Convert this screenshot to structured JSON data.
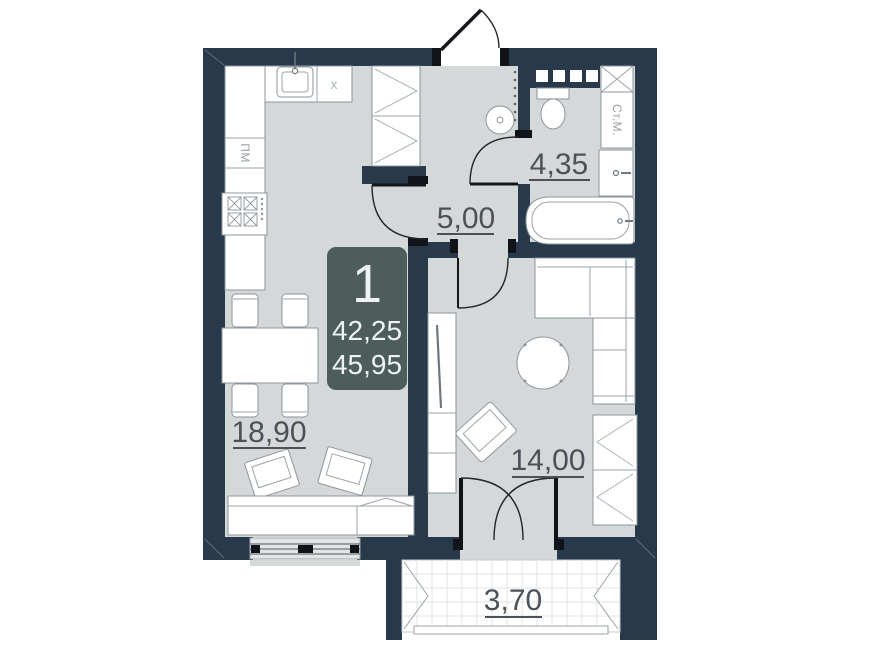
{
  "unit_badge": {
    "rooms_count": "1",
    "area_top": "42,25",
    "area_bottom": "45,95"
  },
  "rooms": {
    "kitchen_living": {
      "area": "18,90"
    },
    "hallway": {
      "area": "5,00"
    },
    "bathroom": {
      "area": "4,35"
    },
    "main_room": {
      "area": "14,00"
    },
    "balcony": {
      "area": "3,70"
    }
  },
  "fixture_labels": {
    "dishwasher": "ПМ",
    "washing_machine": "Ст.М.",
    "cooktop": "x"
  },
  "colors": {
    "wall": "#27394b",
    "floor": "#d4d8d9",
    "badge": "#4d5e5a",
    "label": "#4a5158"
  }
}
